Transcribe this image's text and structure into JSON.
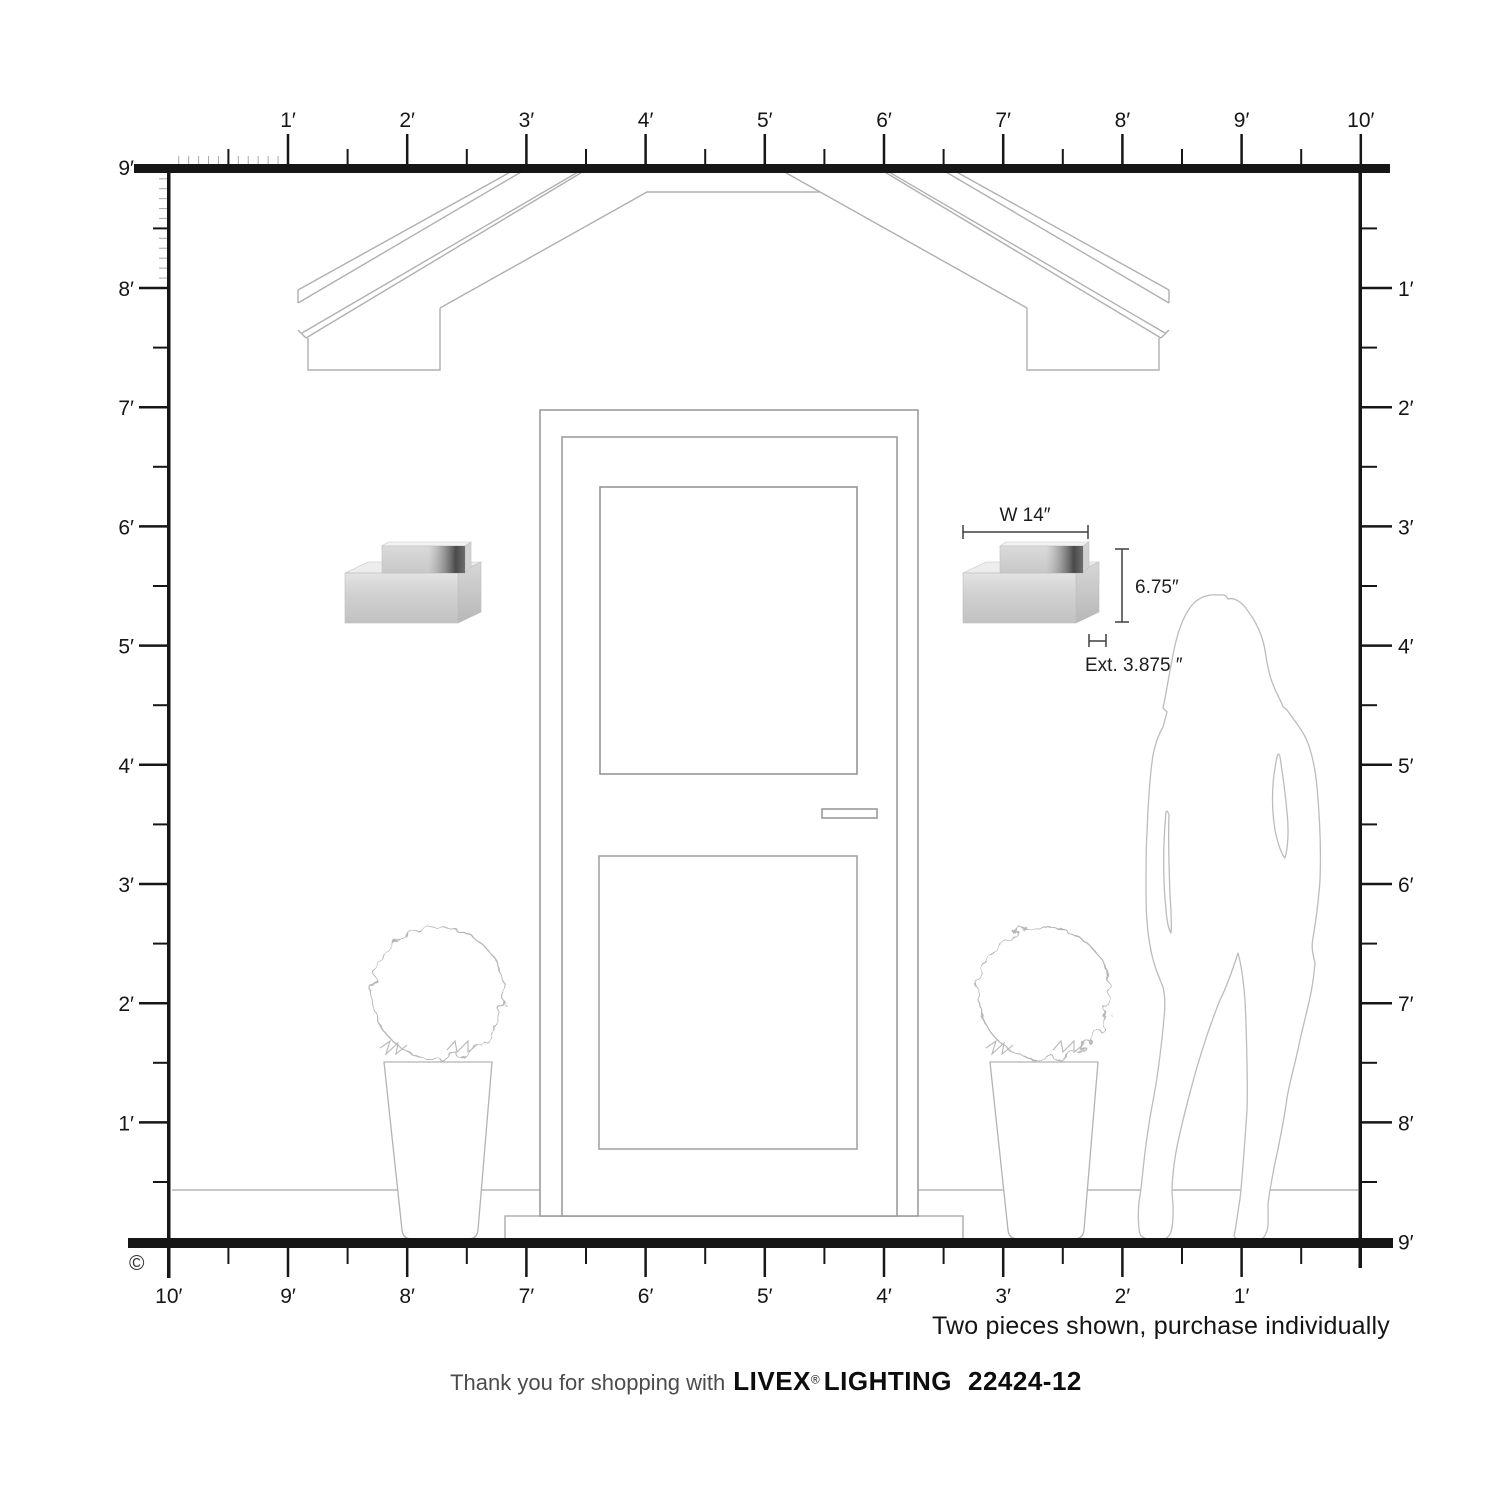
{
  "diagram": {
    "title_hidden": "",
    "scale_unit_feet_px": 119.2
  },
  "rulers": {
    "top": {
      "labels": [
        "1′",
        "2′",
        "3′",
        "4′",
        "5′",
        "6′",
        "7′",
        "8′",
        "9′",
        "10′"
      ]
    },
    "left": {
      "labels": [
        "9′",
        "8′",
        "7′",
        "6′",
        "5′",
        "4′",
        "3′",
        "2′",
        "1′"
      ]
    },
    "right": {
      "labels": [
        "1′",
        "2′",
        "3′",
        "4′",
        "5′",
        "6′",
        "7′",
        "8′",
        "9′"
      ]
    },
    "bottom": {
      "labels": [
        "10′",
        "9′",
        "8′",
        "7′",
        "6′",
        "5′",
        "4′",
        "3′",
        "2′",
        "1′"
      ]
    }
  },
  "dimensions": {
    "width_label": "W 14″",
    "height_label": "6.75″",
    "extension_label": "Ext. 3.875 ″"
  },
  "footer": {
    "note": "Two pieces shown, purchase individually",
    "thanks_prefix": "Thank you for shopping with",
    "brand": "LIVEX",
    "registered_mark": "®",
    "brand_suffix": "LIGHTING",
    "model_number": "22424-12",
    "copyright_symbol": "©"
  },
  "colors": {
    "ruler": "#161616",
    "line_art": "#b0b0b0",
    "door_line": "#9d9d9d",
    "metal_light": "#e2e2e2",
    "metal_mid": "#c7c7c7",
    "metal_dark": "#474747",
    "dimension_line": "#3f3f3f"
  }
}
